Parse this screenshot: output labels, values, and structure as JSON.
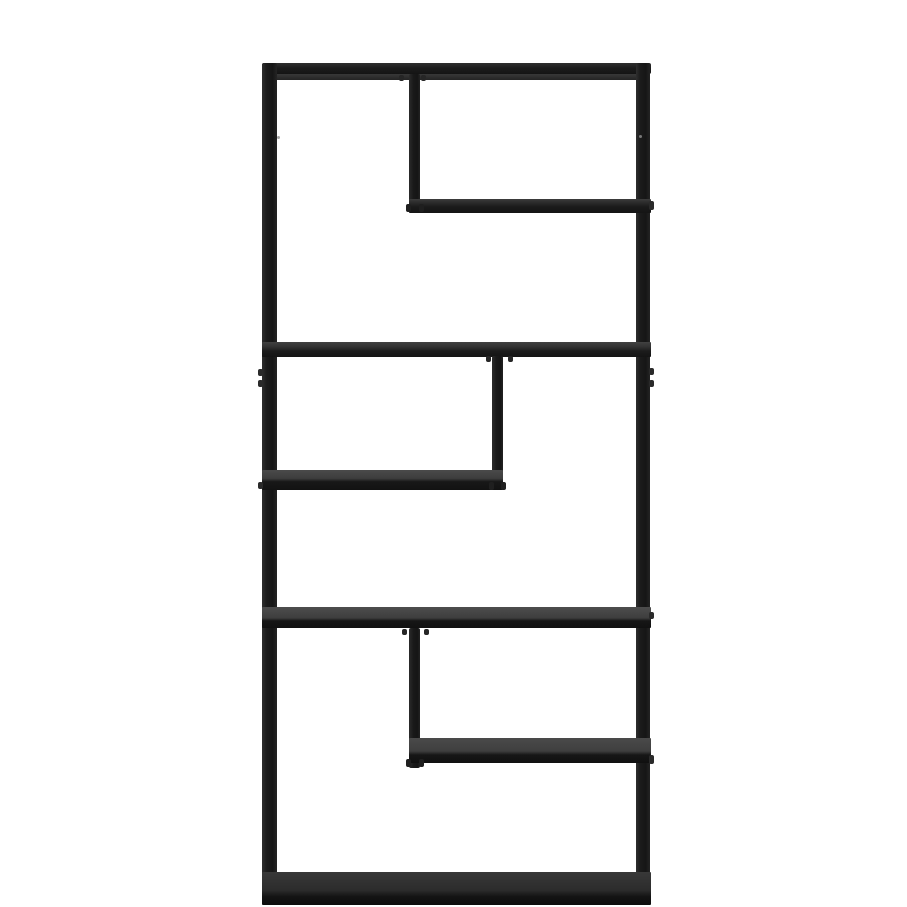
{
  "photo": {
    "alt_text": "Black metal asymmetric etagere bookcase with an open back and six staggered shelves, photographed on a plain white studio background",
    "object_name": "Asymmetric metal etagere bookcase",
    "style": "open-frame staggered-shelf unit",
    "shelf_count": 6,
    "divider_count": 3,
    "colors": {
      "background": "#ffffff",
      "frame_black": "#1b1b1b",
      "shelf_surface_gray": "#3f3f3f",
      "shelf_edge_black": "#141414",
      "hardware_gray": "#8f8f8f"
    },
    "parts": [
      {
        "name": "frame-top-bar",
        "role": "top frame rail spanning full width"
      },
      {
        "name": "frame-left-post",
        "role": "left vertical frame post"
      },
      {
        "name": "frame-right-post",
        "role": "right vertical frame post"
      },
      {
        "name": "shelf-top-right",
        "role": "upper shelf spanning right two-thirds"
      },
      {
        "name": "divider-post-1",
        "role": "short vertical divider from top rail to upper shelf"
      },
      {
        "name": "shelf-middle-upper",
        "role": "full-width shelf, second level"
      },
      {
        "name": "divider-post-2",
        "role": "short vertical divider from second shelf to left half-shelf"
      },
      {
        "name": "shelf-left-half",
        "role": "half shelf spanning left side"
      },
      {
        "name": "shelf-middle-lower",
        "role": "full-width shelf, fourth level"
      },
      {
        "name": "divider-post-3",
        "role": "short vertical divider from fourth shelf to right half-shelf"
      },
      {
        "name": "shelf-right-half",
        "role": "half shelf spanning right side"
      },
      {
        "name": "shelf-bottom",
        "role": "full-width bottom shelf near floor"
      }
    ]
  }
}
